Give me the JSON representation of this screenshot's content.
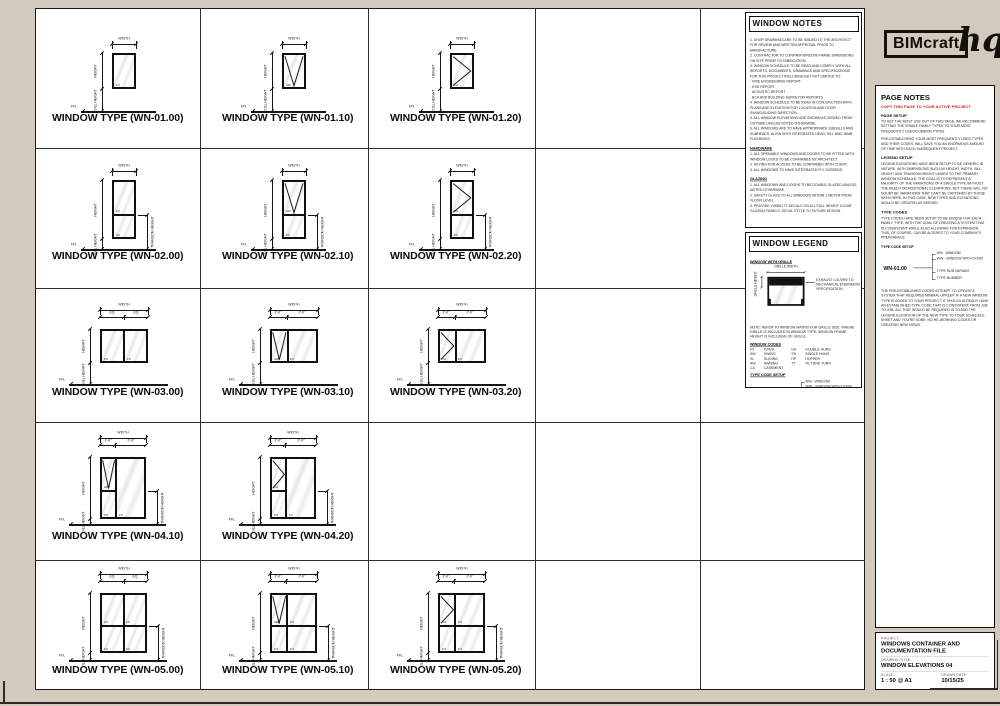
{
  "logo": {
    "name": "BIMcraft",
    "suffix": "hq"
  },
  "dim_labels": {
    "width": "WIDTH",
    "height": "HEIGHT",
    "sill": "SILL HEIGHT",
    "transom": "TRANSOM HEIGHT",
    "ffl": "FFL"
  },
  "window_notes": {
    "title": "WINDOW NOTES",
    "general": [
      "1.  SHOP DRAWINGS ARE TO BE ISSUED TO THE ARCHITECT FOR REVIEW AND WRITTEN APPROVAL PRIOR TO MANUFACTURE.",
      "2.  CONTRACTOR TO CONFIRM WINDOW FRAME DIMENSIONS ON SITE PRIOR TO FABRICATION.",
      "3.  WINDOW SCHEDULE TO BE READ AND COMPLY WITH ALL REPORTS, DOCUMENTS, DRAWINGS AND SPECIFICATIONS FOR THIS PROJECT INCLUDING BUT NOT LIMITED TO:\n    - FIRE ENGINEERING REPORT\n    - ESD REPORT\n    - ACOUSTIC REPORT\n    - BCA AND BUILDING SURVEYOR REPORTS",
      "4.  WINDOW SCHEDULE TO BE READ IN CONJUNCTION WITH PLANS AND ELEVATION FOR LOCATION AND DOOR SWING/SLIDING DIRECTION.",
      "5.  ALL WINDOW ELEVATIONS ARE SHOWN AS VIEWED FROM OUTSIDE UNLESS NOTED OTHERWISE.",
      "6.  ALL WINDOWS ARE TO HAVE APPROPRIATE SUBSILLS AND SUBHEADS, ALIGN WITH INTEGRATED HEAD, SILL AND JAMB FLASHINGS."
    ],
    "hardware_heading": "HARDWARE",
    "hardware": [
      "1.  ALL OPENABLE WINDOWS AND DOORS TO BE FITTED WITH WINDOW LOCKS TO BE CONFIRMED BY ARCHITECT.",
      "2.  KEYING FOR ACCESS TO BE CONFIRMED WITH CLIENT.",
      "3.  ALL WINDOWS TO HAVE INTEGRATED FLY SCREENS."
    ],
    "glazing_heading": "GLAZING",
    "glazing": [
      "1.  ALL WINDOWS AND DOORS TO BE DOUBLE GLAZED UNLESS NOTED OTHERWISE.",
      "2.  SAFETY GLASS TO ALL WINDOWS WITHIN 1 METER FROM FLOOR LEVEL.",
      "3.  PROVIDE VISIBILITY DECALS ON ALL FULL HEIGHT CLEAR GLAZING PANELS. DECAL STYLE TO FUTURE DESIGN."
    ]
  },
  "window_legend": {
    "title": "WINDOW LEGEND",
    "grille_heading": "WINDOW WITH GRILLE",
    "grille_width_label": "GRILLE WIDTH",
    "grille_height_label": "GRILLE HEIGHT",
    "grille_annotation": "EXHAUST LOUVRE TO MECHANICAL ENGINEERS SPECIFICATION",
    "grille_note": "NOTE: REFER TO WINDOW MATRIX FOR GRILLE SIZE. WHERE GRILLE IS INCLUDED IN WINDOW TYPE, WINDOW FRAME HEIGHT IS INCLUSIVE OF GRILLE.",
    "codes_heading": "WINDOW CODES",
    "codes_left": [
      [
        "FX",
        "FIXED"
      ],
      [
        "SW",
        "SWING"
      ],
      [
        "SL",
        "SLIDING"
      ],
      [
        "AW",
        "AWNING"
      ],
      [
        "CA",
        "CASEMENT"
      ]
    ],
    "codes_right": [
      [
        "DH",
        "DOUBLE HUNG"
      ],
      [
        "SH",
        "SINGLE HUNG"
      ],
      [
        "HP",
        "HOPPER"
      ],
      [
        "TT",
        "TILT AND TURN"
      ]
    ]
  },
  "type_code": {
    "setup_label": "TYPE CODE SETUP",
    "example": "WN-01.00",
    "wn": "WN - WINDOW",
    "ww": "WW - WINDOW WITH DOOR",
    "variant": "TYPE SUB VARIANT",
    "number": "TYPE NUMBER"
  },
  "page_notes": {
    "title": "PAGE NOTES",
    "copy_warning": "COPY THIS PAGE TO YOUR ACTIVE PROJECT",
    "page_setup_heading": "PAGE SETUP",
    "page_setup_p1": "TO GET THE MOST USE OUT OF THIS PAGE, WE RECOMMEND SETTING THE VISIBLE FAMILY TYPES TO YOUR MOST FREQUENTLY USED/COMMON TYPES.",
    "page_setup_p2": "PRE-ESTABLISHING YOUR MOST FREQUENTLY USED TYPES AND THEIR CODES, WILL SAVE YOU AN ENORMOUS AMOUNT OF TIME WITH EACH SUBSEQUENT PROJECT.",
    "legend_setup_heading": "LEGEND SETUP",
    "legend_setup_p": "LEGEND ELEVATIONS HAVE BEEN SETUP TO BE GENERIC IN NATURE, WITH DIMENSIONS SUCH AS HEIGHT, WIDTH, SILL HEIGHT AND TRANSOM HEIGHT LINKED TO THE PRIMARY WINDOW SCHEDULE. THE GOAL IS TO REPRESENT A MAJORITY OF THE VARIATIONS OF A SINGLE TYPE WITHOUT THE NEED FOR ADDITIONAL ELEVATIONS, BUT THERE WILL NO DOUBT BE VARIATIONS THAT CAN'T BE CAPTURED BY THOSE SEEN HERE. IN THIS CASE, NEW TYPES AND ELEVATIONS WOULD BE CREATED AS NEEDED.",
    "type_codes_heading": "TYPE CODES",
    "type_codes_p": "TYPE CODES HAVE BEEN SETUP TO BE UNIQUE FOR EACH FAMILY TYPE, WITH THE GOAL OF CREATING A SYSTEM THAT IS CONSISTENT WHILE ALSO ALLOWING FOR EXPANSION. THIS, OF COURSE, CAN BE ALTERED TO YOUR COMPANY'S PREFERENCE.",
    "closing_p": "THE PRE-ESTABLISHED CODES ATTEMPT TO CREATE A SYSTEM THAT REQUIRES MINIMAL UPKEEP. IF A NEW WINDOW TYPE IS ADDED TO YOUR PROJECT, IT SHOULD ALREADY HAVE AN ESTABLISHED TYPE CODE THAT IS CONSISTENT FROM JOB TO JOB. ALL THAT WOULD BE REQUIRED IS TO ADD THE LEGEND ELEVATION OF THE NEW TYPE TO YOUR SCHEDULE SHEET AND YOU'RE DONE. NO RE-WORKING CODES OR CREATING NEW VIEWS."
  },
  "title_block": {
    "project_label": "PROJECT",
    "project": "WINDOWS CONTAINER AND DOCUMENTATION FILE",
    "drawing_label": "DRAWING TITLE",
    "drawing": "WINDOW ELEVATIONS 04",
    "scale_label": "SCALE",
    "scale": "1 : 50 @ A1",
    "date_label": "DRAWN DATE",
    "date": "10/15/25"
  },
  "windows": [
    {
      "code": "WN-01.00",
      "caption": "WINDOW TYPE (WN-01.00)",
      "x": 112,
      "y": 53,
      "w": 24,
      "h": 36,
      "cols": [
        1
      ],
      "rows": [
        1
      ],
      "panes": [
        {
          "c": 0,
          "r": 0,
          "g": "FX"
        }
      ],
      "ground": 111,
      "cap_x": 52,
      "cap_y": 112,
      "sub": null,
      "transom": false
    },
    {
      "code": "WN-01.10",
      "caption": "WINDOW TYPE (WN-01.10)",
      "x": 282,
      "y": 53,
      "w": 24,
      "h": 36,
      "cols": [
        1
      ],
      "rows": [
        1
      ],
      "panes": [
        {
          "c": 0,
          "r": 0,
          "g": "AW"
        }
      ],
      "ground": 111,
      "cap_x": 222,
      "cap_y": 112,
      "sub": null,
      "transom": false
    },
    {
      "code": "WN-01.20",
      "caption": "WINDOW TYPE (WN-01.20)",
      "x": 450,
      "y": 53,
      "w": 24,
      "h": 36,
      "cols": [
        1
      ],
      "rows": [
        1
      ],
      "panes": [
        {
          "c": 0,
          "r": 0,
          "g": "CA"
        }
      ],
      "ground": 111,
      "cap_x": 390,
      "cap_y": 112,
      "sub": null,
      "transom": false
    },
    {
      "code": "WN-02.00",
      "caption": "WINDOW TYPE (WN-02.00)",
      "x": 112,
      "y": 180,
      "w": 24,
      "h": 59,
      "cols": [
        1
      ],
      "rows": [
        0.6,
        0.4
      ],
      "panes": [
        {
          "c": 0,
          "r": 0,
          "g": "FX"
        },
        {
          "c": 0,
          "r": 1,
          "g": "FX"
        }
      ],
      "ground": 249,
      "cap_x": 52,
      "cap_y": 250,
      "sub": null,
      "transom": true
    },
    {
      "code": "WN-02.10",
      "caption": "WINDOW TYPE (WN-02.10)",
      "x": 282,
      "y": 180,
      "w": 24,
      "h": 59,
      "cols": [
        1
      ],
      "rows": [
        0.6,
        0.4
      ],
      "panes": [
        {
          "c": 0,
          "r": 0,
          "g": "AW"
        },
        {
          "c": 0,
          "r": 1,
          "g": "FX"
        }
      ],
      "ground": 249,
      "cap_x": 222,
      "cap_y": 250,
      "sub": null,
      "transom": true
    },
    {
      "code": "WN-02.20",
      "caption": "WINDOW TYPE (WN-02.20)",
      "x": 450,
      "y": 180,
      "w": 24,
      "h": 59,
      "cols": [
        1
      ],
      "rows": [
        0.6,
        0.4
      ],
      "panes": [
        {
          "c": 0,
          "r": 0,
          "g": "CA"
        },
        {
          "c": 0,
          "r": 1,
          "g": "FX"
        }
      ],
      "ground": 249,
      "cap_x": 390,
      "cap_y": 250,
      "sub": null,
      "transom": true
    },
    {
      "code": "WN-03.00",
      "caption": "WINDOW TYPE (WN-03.00)",
      "x": 100,
      "y": 329,
      "w": 48,
      "h": 34,
      "cols": [
        1,
        1
      ],
      "rows": [
        1
      ],
      "panes": [
        {
          "c": 0,
          "r": 0,
          "g": "FX"
        },
        {
          "c": 1,
          "r": 0,
          "g": "FX"
        }
      ],
      "ground": 384,
      "cap_x": 52,
      "cap_y": 386,
      "sub": [
        "EQ",
        "EQ"
      ],
      "transom": false
    },
    {
      "code": "WN-03.10",
      "caption": "WINDOW TYPE (WN-03.10)",
      "x": 270,
      "y": 329,
      "w": 48,
      "h": 34,
      "cols": [
        0.35,
        0.65
      ],
      "rows": [
        1
      ],
      "panes": [
        {
          "c": 0,
          "r": 0,
          "g": "AW"
        },
        {
          "c": 1,
          "r": 0,
          "g": "FX"
        }
      ],
      "ground": 384,
      "cap_x": 222,
      "cap_y": 386,
      "sub": [
        "1'-0\"",
        "2'-0\""
      ],
      "transom": false
    },
    {
      "code": "WN-03.20",
      "caption": "WINDOW TYPE (WN-03.20)",
      "x": 438,
      "y": 329,
      "w": 48,
      "h": 34,
      "cols": [
        0.35,
        0.65
      ],
      "rows": [
        1
      ],
      "panes": [
        {
          "c": 0,
          "r": 0,
          "g": "CA"
        },
        {
          "c": 1,
          "r": 0,
          "g": "FX"
        }
      ],
      "ground": 384,
      "cap_x": 390,
      "cap_y": 386,
      "sub": [
        "1'-0\"",
        "2'-0\""
      ],
      "transom": false
    },
    {
      "code": "WN-04.10",
      "caption": "WINDOW TYPE (WN-04.10)",
      "x": 100,
      "y": 457,
      "w": 46,
      "h": 62,
      "cols": [
        0.33,
        0.67
      ],
      "rows": [
        0.55,
        0.45
      ],
      "panes": [
        {
          "c": 0,
          "r": 0,
          "g": "AW"
        },
        {
          "c": 0,
          "r": 1,
          "g": "FX"
        },
        {
          "c": 1,
          "r": 0,
          "rs": 2,
          "g": "FX"
        }
      ],
      "ground": 524,
      "cap_x": 52,
      "cap_y": 530,
      "sub": [
        "1'-0\"",
        "2'-0\""
      ],
      "transom": true
    },
    {
      "code": "WN-04.20",
      "caption": "WINDOW TYPE (WN-04.20)",
      "x": 270,
      "y": 457,
      "w": 46,
      "h": 62,
      "cols": [
        0.33,
        0.67
      ],
      "rows": [
        0.55,
        0.45
      ],
      "panes": [
        {
          "c": 0,
          "r": 0,
          "g": "CA"
        },
        {
          "c": 0,
          "r": 1,
          "g": "FX"
        },
        {
          "c": 1,
          "r": 0,
          "rs": 2,
          "g": "FX"
        }
      ],
      "ground": 524,
      "cap_x": 222,
      "cap_y": 530,
      "sub": [
        "1'-0\"",
        "2'-0\""
      ],
      "transom": true
    },
    {
      "code": "WN-05.00",
      "caption": "WINDOW TYPE (WN-05.00)",
      "x": 100,
      "y": 593,
      "w": 47,
      "h": 60,
      "cols": [
        1,
        1
      ],
      "rows": [
        0.55,
        0.45
      ],
      "panes": [
        {
          "c": 0,
          "r": 0,
          "g": "FX"
        },
        {
          "c": 1,
          "r": 0,
          "g": "FX"
        },
        {
          "c": 0,
          "r": 1,
          "g": "FX"
        },
        {
          "c": 1,
          "r": 1,
          "g": "FX"
        }
      ],
      "ground": 660,
      "cap_x": 52,
      "cap_y": 664,
      "sub": [
        "EQ",
        "EQ"
      ],
      "transom": true
    },
    {
      "code": "WN-05.10",
      "caption": "WINDOW TYPE (WN-05.10)",
      "x": 270,
      "y": 593,
      "w": 47,
      "h": 60,
      "cols": [
        0.35,
        0.65
      ],
      "rows": [
        0.55,
        0.45
      ],
      "panes": [
        {
          "c": 0,
          "r": 0,
          "g": "AW"
        },
        {
          "c": 1,
          "r": 0,
          "g": "FX"
        },
        {
          "c": 0,
          "r": 1,
          "g": "FX"
        },
        {
          "c": 1,
          "r": 1,
          "g": "FX"
        }
      ],
      "ground": 660,
      "cap_x": 222,
      "cap_y": 664,
      "sub": [
        "1'-0\"",
        "2'-0\""
      ],
      "transom": true
    },
    {
      "code": "WN-05.20",
      "caption": "WINDOW TYPE (WN-05.20)",
      "x": 438,
      "y": 593,
      "w": 47,
      "h": 60,
      "cols": [
        0.35,
        0.65
      ],
      "rows": [
        0.55,
        0.45
      ],
      "panes": [
        {
          "c": 0,
          "r": 0,
          "g": "CA"
        },
        {
          "c": 1,
          "r": 0,
          "g": "FX"
        },
        {
          "c": 0,
          "r": 1,
          "g": "FX"
        },
        {
          "c": 1,
          "r": 1,
          "g": "FX"
        }
      ],
      "ground": 660,
      "cap_x": 390,
      "cap_y": 664,
      "sub": [
        "1'-0\"",
        "2'-0\""
      ],
      "transom": true
    }
  ]
}
